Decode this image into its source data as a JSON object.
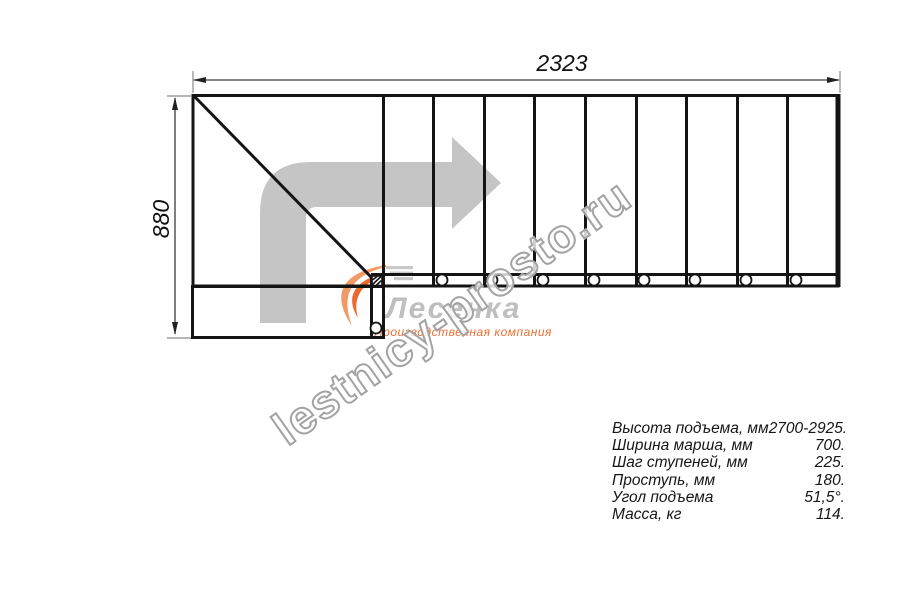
{
  "page": {
    "background": "#ffffff"
  },
  "drawing": {
    "dim_width_mm": "2323",
    "dim_height_mm": "880",
    "line_color": "#141414",
    "dim_line_color": "#3a3a3a",
    "ext_line_color": "#8a8a8a",
    "direction_arrow_color": "#c5c5c5",
    "plan": {
      "risers_x": [
        433,
        484,
        534,
        585,
        636,
        686,
        737,
        787
      ],
      "balusters_x": [
        442,
        492,
        543,
        594,
        644,
        695,
        746,
        796
      ],
      "baluster_y": 280,
      "baluster_r": 5.5,
      "lower_baluster": {
        "x": 376,
        "y": 328,
        "r": 5.5
      }
    }
  },
  "watermark": {
    "text": "lestnicy-prosto.ru",
    "outline_color": "#a3a3a3"
  },
  "logo": {
    "name": "Лесенка",
    "tagline": "Производственная компания",
    "orange": "#ed6a2e",
    "orange_light": "#f29a66",
    "grey": "#bfbfbf"
  },
  "specs": {
    "rows": [
      {
        "label": "Высота подъема, мм",
        "value": "2700-2925."
      },
      {
        "label": "Ширина марша, мм",
        "value": "700."
      },
      {
        "label": "Шаг ступеней, мм",
        "value": "225."
      },
      {
        "label": "Проступь, мм",
        "value": "180."
      },
      {
        "label": "Угол подъема",
        "value": "51,5°."
      },
      {
        "label": "Масса, кг",
        "value": "114."
      }
    ]
  }
}
